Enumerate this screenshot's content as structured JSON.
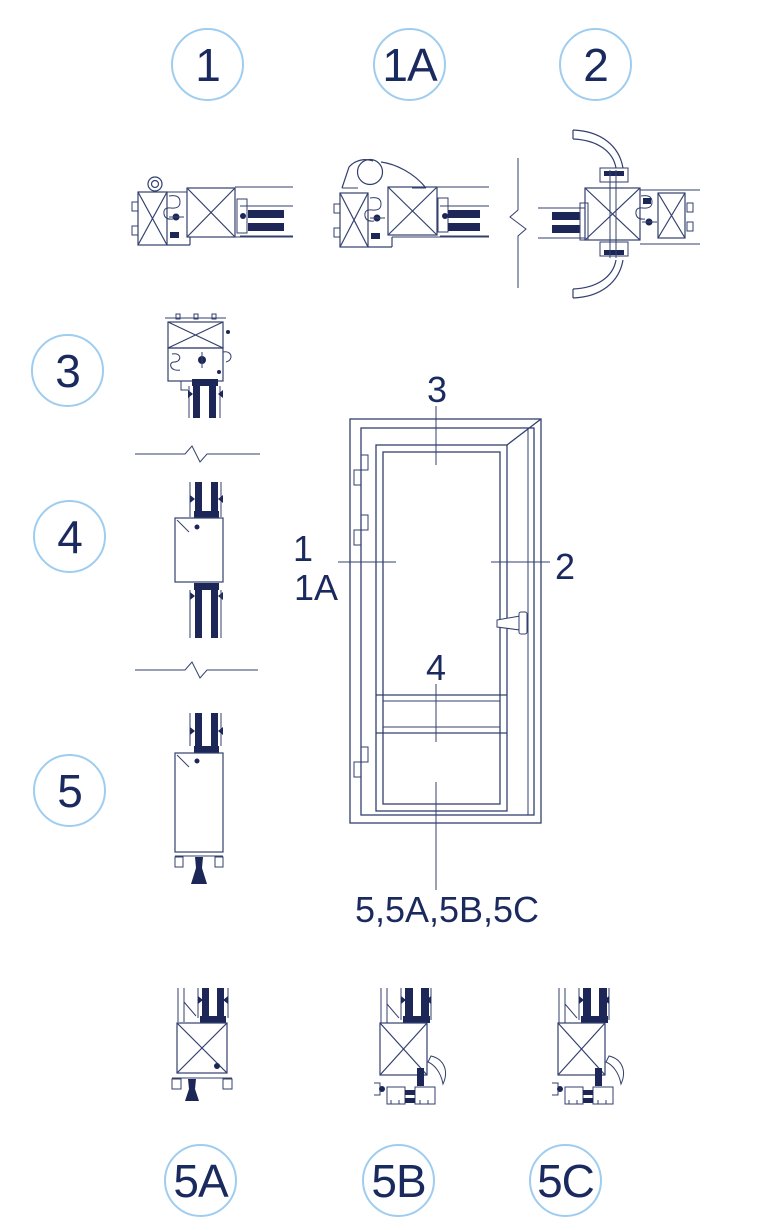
{
  "figure": {
    "type": "technical-drawing-door-sections",
    "callouts": [
      {
        "id": "1",
        "label": "1"
      },
      {
        "id": "1A",
        "label": "1A"
      },
      {
        "id": "2",
        "label": "2"
      },
      {
        "id": "3",
        "label": "3"
      },
      {
        "id": "4",
        "label": "4"
      },
      {
        "id": "5",
        "label": "5"
      },
      {
        "id": "5A",
        "label": "5A"
      },
      {
        "id": "5B",
        "label": "5B"
      },
      {
        "id": "5C",
        "label": "5C"
      }
    ],
    "door_annotations": {
      "top": "3",
      "left_primary": "1",
      "left_secondary": "1A",
      "right": "2",
      "middle": "4",
      "bottom": "5,5A,5B,5C"
    },
    "colors": {
      "line": "#33406e",
      "dark_fill": "#1c2757",
      "text": "#1b2a5e",
      "callout_ring": "#9fcdf0",
      "background": "#ffffff"
    }
  }
}
